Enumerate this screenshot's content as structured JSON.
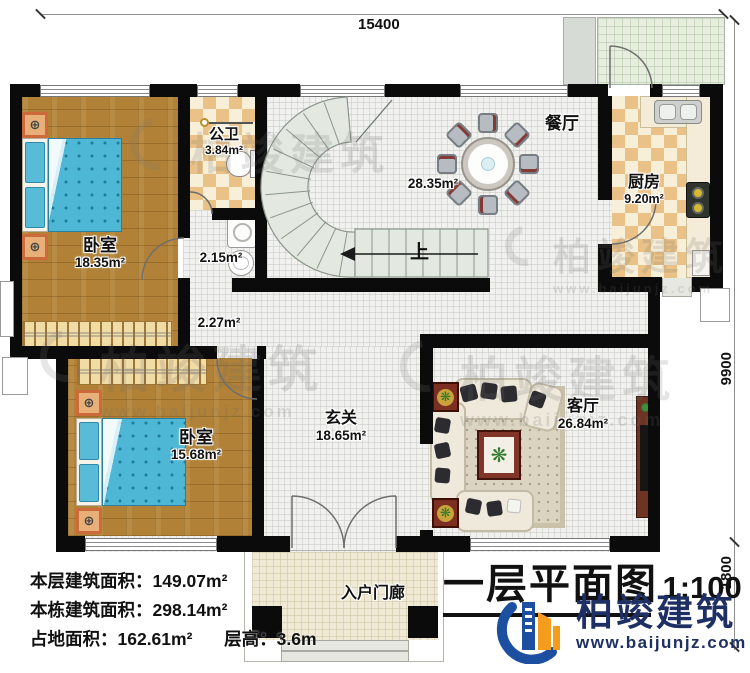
{
  "dims": {
    "top": "15400",
    "right": "9900",
    "right_lower": "1800"
  },
  "rooms": {
    "bedroom1": {
      "name": "卧室",
      "area": "18.35m²"
    },
    "bathroom": {
      "name": "公卫",
      "area": "3.84m²"
    },
    "utility_area": "2.15m²",
    "understair_area": "2.27m²",
    "dining": {
      "name": "餐厅",
      "area": "28.35m²"
    },
    "kitchen": {
      "name": "厨房",
      "area": "9.20m²"
    },
    "bedroom2": {
      "name": "卧室",
      "area": "15.68m²"
    },
    "foyer": {
      "name": "玄关",
      "area": "18.65m²"
    },
    "living": {
      "name": "客厅",
      "area": "26.84m²"
    },
    "porch": {
      "name": "入户门廊"
    },
    "stair_up": "上"
  },
  "stats": {
    "line1": {
      "label": "本层建筑面积：",
      "value": "149.07m²"
    },
    "line2": {
      "label": "本栋建筑面积：",
      "value": "298.14m²"
    },
    "line3": {
      "label": "占地面积：",
      "value": "162.61m²"
    },
    "line4": {
      "label": "层高：",
      "value": "3.6m"
    }
  },
  "title": {
    "name": "一层平面图",
    "scale": "1:100"
  },
  "brand": {
    "company": "柏竣建筑",
    "website": "www.baijunjz.com"
  },
  "watermark": {
    "text": "柏竣建筑",
    "url": "www.baijunjz.com"
  },
  "icons": {
    "knob": "⊕",
    "plant": "❋"
  },
  "colors": {
    "wall": "#0b0b0b",
    "wood": "#b08136",
    "bed": "#4fb7d6",
    "brand_navy": "#1e2f63",
    "brand_orange": "#f49c1e",
    "brand_blue": "#1c4fa0"
  }
}
